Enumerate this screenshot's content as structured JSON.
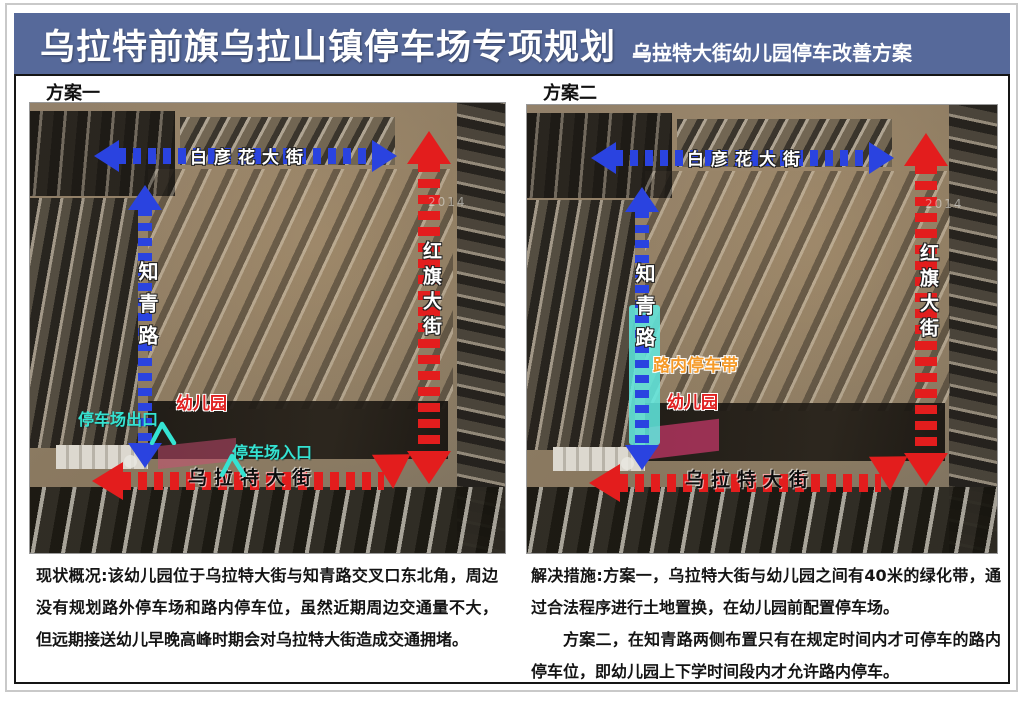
{
  "title": {
    "main": "乌拉特前旗乌拉山镇停车场专项规划",
    "dash": "——",
    "subtitle": "乌拉特大街幼儿园停车改善方案"
  },
  "colors": {
    "title_bar": "#56699a",
    "route_blue": "#2a43e0",
    "route_red": "#e31d1d",
    "accent_cyan": "#35e3d2",
    "accent_orange": "#f59a28",
    "parking_pink": "#c83769"
  },
  "plan1": {
    "label": "方案一",
    "streets": {
      "north": "白彦花大街",
      "west": "知青路",
      "east": "红旗大街",
      "south": "乌拉特大街"
    },
    "annotations": {
      "kindergarten": "幼儿园",
      "parking_exit": "停车场出口",
      "parking_entrance": "停车场入口"
    },
    "imagery_year": "2014"
  },
  "plan2": {
    "label": "方案二",
    "streets": {
      "north": "白彦花大街",
      "west": "知青路",
      "east": "红旗大街",
      "south": "乌拉特大街"
    },
    "annotations": {
      "kindergarten": "幼儿园",
      "onstreet_parking_belt": "路内停车带"
    },
    "imagery_year": "2014"
  },
  "notes": {
    "current_situation": "现状概况:该幼儿园位于乌拉特大街与知青路交叉口东北角，周边没有规划路外停车场和路内停车位，虽然近期周边交通量不大，但远期接送幼儿早晚高峰时期会对乌拉特大街造成交通拥堵。",
    "solution_p1": "解决措施:方案一，乌拉特大街与幼儿园之间有40米的绿化带，通过合法程序进行土地置换，在幼儿园前配置停车场。",
    "solution_p2": "方案二，在知青路两侧布置只有在规定时间内才可停车的路内停车位，即幼儿园上下学时间段内才允许路内停车。"
  }
}
